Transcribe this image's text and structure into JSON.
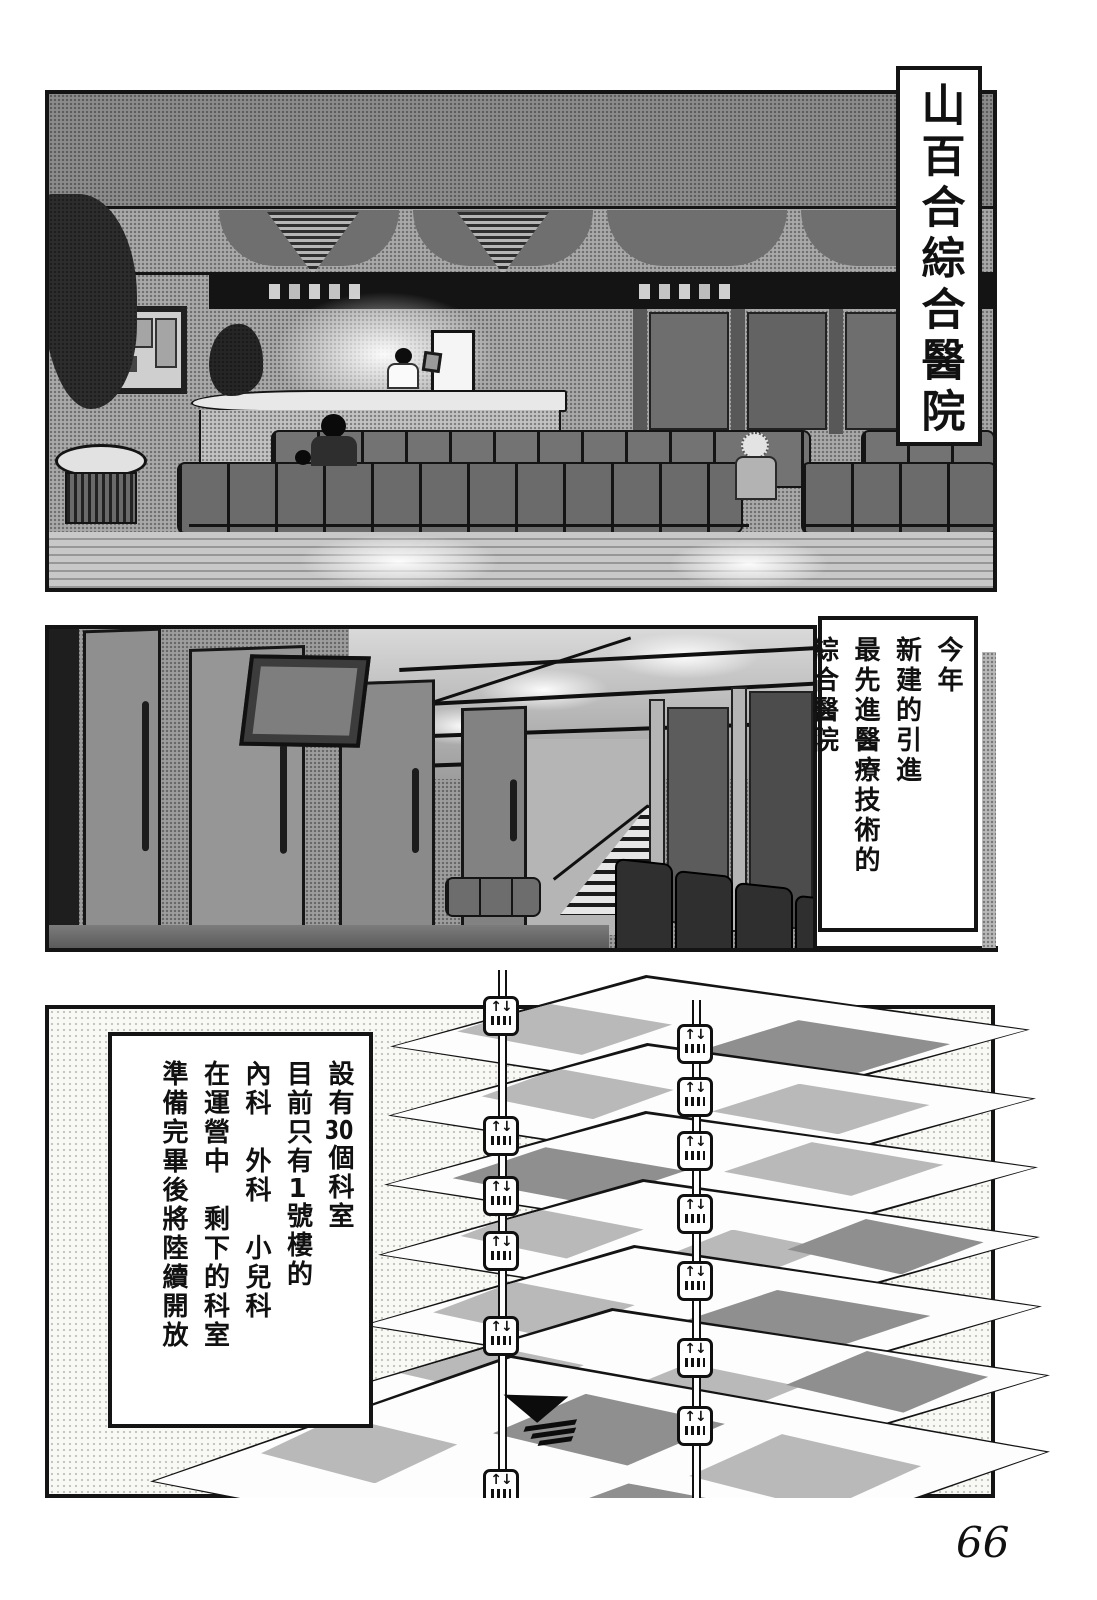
{
  "page_number": "66",
  "colors": {
    "ink": "#141414",
    "paper": "#ffffff",
    "scene_gray": "#a9a9a9"
  },
  "icons": {
    "elevator_glyph": "↑↓",
    "elevator_name": "elevator-pictogram"
  },
  "captions": {
    "panel1_title": "山百合綜合醫院",
    "panel2_lines": [
      "今年",
      "新建的引進",
      "最先進醫療技術的",
      "綜合醫院"
    ],
    "panel3": {
      "col1_pre": "設有",
      "col1_num": "30",
      "col1_post": "個科室",
      "col2_pre": "目前只有",
      "col2_num": "1",
      "col2_post": "號樓的",
      "col3": "內科　外科　小兒科",
      "col4": "在運營中　剩下的科室",
      "col5": "準備完畢後將陸續開放"
    }
  }
}
